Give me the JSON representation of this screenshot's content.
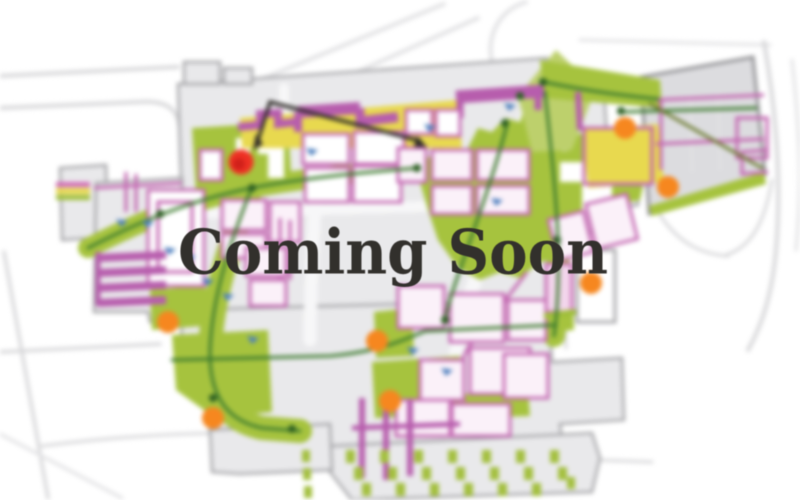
{
  "banner": {
    "title": "Coming Soon"
  },
  "palette": {
    "background": "#ffffff",
    "title_text": "#32302c",
    "road_gray": "#d8d8da",
    "block_gray": "#e9e9eb",
    "panel_gray": "#dcdcdf",
    "outline_gray": "#a5a5a8",
    "greenway": "#a6c33e",
    "greenway_light": "#bdd06c",
    "path_green": "#3c7a2e",
    "magenta": "#c468b2",
    "magenta_solid": "#b75dad",
    "yellow": "#e8d94f",
    "orange": "#f6871f",
    "red": "#ee3124",
    "blue": "#4d7fbe",
    "black": "#2e2a28"
  },
  "markers": {
    "orange_dots": [
      {
        "x": 168,
        "y": 322
      },
      {
        "x": 213,
        "y": 418
      },
      {
        "x": 377,
        "y": 341
      },
      {
        "x": 390,
        "y": 401
      },
      {
        "x": 591,
        "y": 283
      },
      {
        "x": 625,
        "y": 128
      },
      {
        "x": 668,
        "y": 187
      }
    ],
    "red_dot": {
      "x": 241,
      "y": 162
    },
    "blue_ticks": [
      {
        "x": 122,
        "y": 222
      },
      {
        "x": 148,
        "y": 223
      },
      {
        "x": 170,
        "y": 250
      },
      {
        "x": 190,
        "y": 257
      },
      {
        "x": 208,
        "y": 281
      },
      {
        "x": 228,
        "y": 296
      },
      {
        "x": 253,
        "y": 339
      },
      {
        "x": 312,
        "y": 151
      },
      {
        "x": 430,
        "y": 127
      },
      {
        "x": 510,
        "y": 106
      },
      {
        "x": 497,
        "y": 201
      },
      {
        "x": 413,
        "y": 350
      },
      {
        "x": 447,
        "y": 371
      }
    ]
  }
}
